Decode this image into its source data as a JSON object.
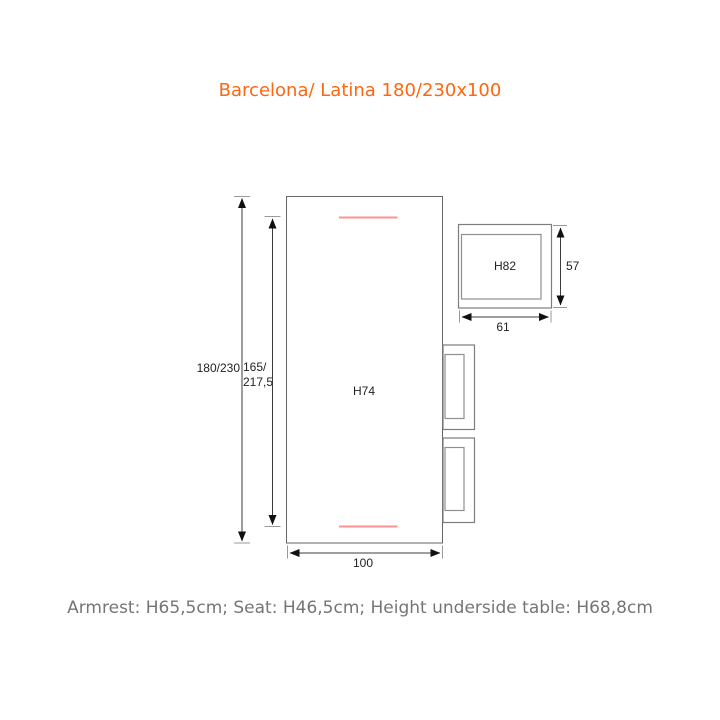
{
  "title": {
    "text": "Barcelona/ Latina 180/230x100",
    "color": "#ff6610"
  },
  "footer": {
    "text": "Armrest: H65,5cm; Seat: H46,5cm; Height underside table: H68,8cm",
    "color": "#757575"
  },
  "diagram": {
    "table": {
      "height_label": "H74",
      "width_dim": "100",
      "total_length_dim": "180/230",
      "inner_length_dim_line1": "165/",
      "inner_length_dim_line2": "217,5"
    },
    "chair": {
      "height_label": "H82",
      "depth_dim": "57",
      "width_dim": "61"
    },
    "colors": {
      "table_outline": "#666666",
      "chair_outline": "#7d7d7d",
      "chair_seat_outline": "#8f8f8f",
      "dimension_line": "#3c3c3c",
      "arrowhead": "#101010",
      "extension_tick": "#999999",
      "extension_leaf_marker": "#fb9393"
    }
  }
}
